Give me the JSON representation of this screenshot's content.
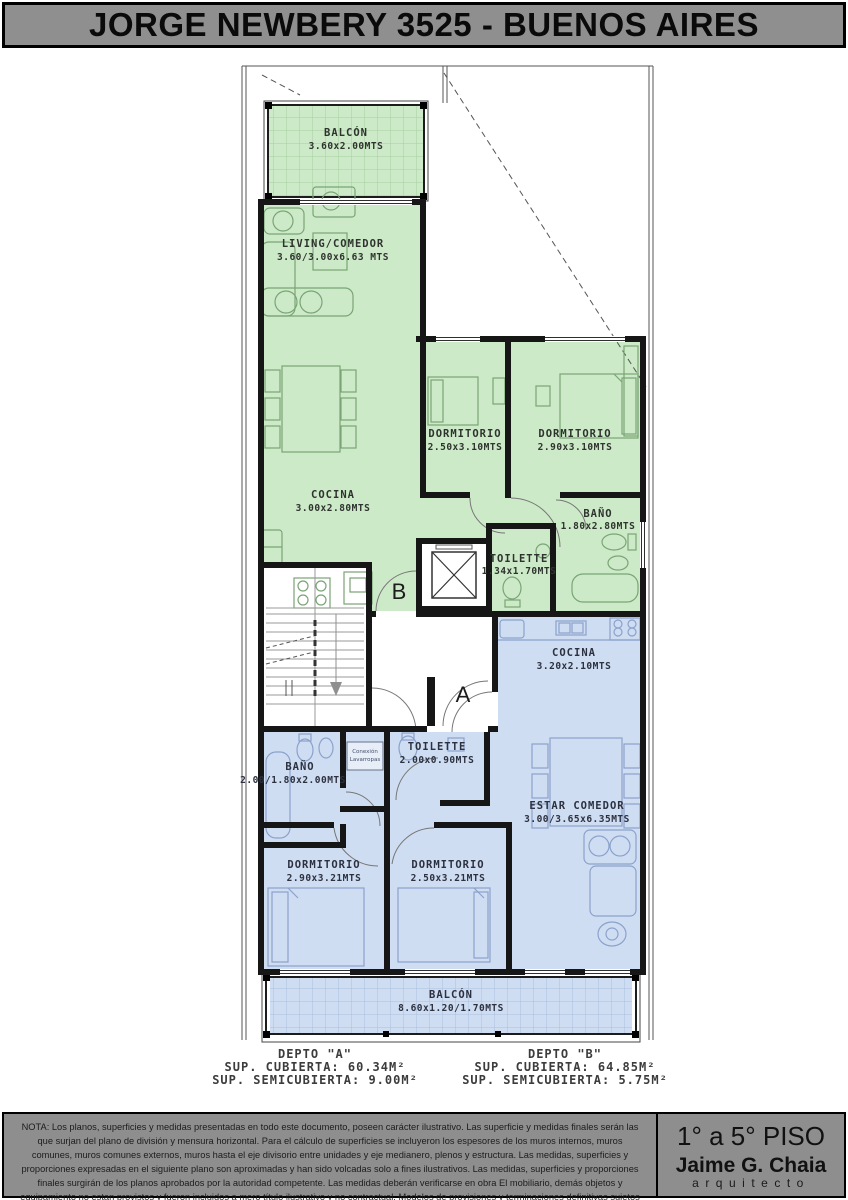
{
  "title": "JORGE NEWBERY 3525 - BUENOS AIRES",
  "colors": {
    "header_bg": "#8f8f8f",
    "unit_b_fill": "#cdeac8",
    "unit_a_fill": "#cfddf2",
    "wall": "#161616",
    "note_bg": "#8e8e8e"
  },
  "plan": {
    "unit_b": {
      "tag": "B",
      "balcon": {
        "name": "BALCÓN",
        "dims": "3.60x2.00MTS"
      },
      "living": {
        "name": "LIVING/COMEDOR",
        "dims": "3.60/3.00x6.63 MTS"
      },
      "dorm1": {
        "name": "DORMITORIO",
        "dims": "2.50x3.10MTS"
      },
      "dorm2": {
        "name": "DORMITORIO",
        "dims": "2.90x3.10MTS"
      },
      "cocina": {
        "name": "COCINA",
        "dims": "3.00x2.80MTS"
      },
      "bano": {
        "name": "BAÑO",
        "dims": "1.80x2.80MTS"
      },
      "toilette": {
        "name": "TOILETTE",
        "dims": "1.34x1.70MTS"
      }
    },
    "unit_a": {
      "tag": "A",
      "cocina": {
        "name": "COCINA",
        "dims": "3.20x2.10MTS"
      },
      "bano": {
        "name": "BAÑO",
        "dims": "2.00/1.80x2.00MTS"
      },
      "toilette": {
        "name": "TOILETTE",
        "dims": "2.00x0.90MTS"
      },
      "lavarropas": {
        "line1": "Conexión",
        "line2": "Lavarropas"
      },
      "estar": {
        "name": "ESTAR COMEDOR",
        "dims": "3.00/3.65x6.35MTS"
      },
      "dorm1": {
        "name": "DORMITORIO",
        "dims": "2.90x3.21MTS"
      },
      "dorm2": {
        "name": "DORMITORIO",
        "dims": "2.50x3.21MTS"
      },
      "balcon": {
        "name": "BALCÓN",
        "dims": "8.60x1.20/1.70MTS"
      }
    }
  },
  "summary": {
    "depto_a": {
      "title": "DEPTO \"A\"",
      "cubierta": "SUP. CUBIERTA: 60.34M²",
      "semicubierta": "SUP. SEMICUBIERTA: 9.00M²"
    },
    "depto_b": {
      "title": "DEPTO \"B\"",
      "cubierta": "SUP. CUBIERTA: 64.85M²",
      "semicubierta": "SUP. SEMICUBIERTA: 5.75M²"
    }
  },
  "footer": {
    "nota": "NOTA:   Los planos, superficies y medidas presentadas en todo este documento, poseen carácter ilustrativo. Las superficie y medidas finales serán las que surjan del plano de división y mensura horizontal. Para el cálculo de superficies se incluyeron los espesores de los muros internos, muros comunes, muros comunes externos, muros hasta el eje divisorio entre unidades y eje medianero, plenos y estructura. Las medidas, superficies y proporciones expresadas en el siguiente plano son aproximadas y han sido volcadas solo a fines ilustrativos. Las medidas, superficies y proporciones finales surgirán de los planos aprobados por la autoridad competente. Las medidas deberán verificarse en obra El mobiliario, demás objetos y equipamiento no estan provistos y fueron incluidos a mero título ilustrativo y no contractual. Modelos de provisiones y terminaciones definitivas sujetos a definiciones durante la contratación.",
    "piso": "1° a 5° PISO",
    "architect": "Jaime G. Chaia",
    "architect_title": "arquitecto"
  }
}
